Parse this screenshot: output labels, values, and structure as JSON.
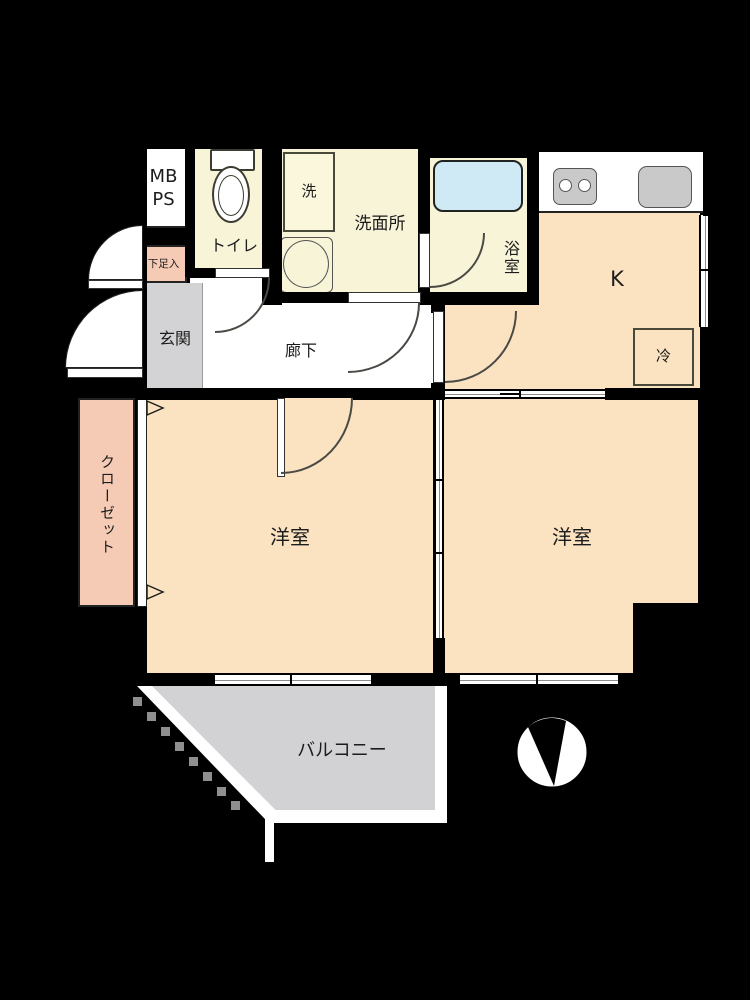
{
  "floorplan": {
    "labels": {
      "mb": "MB",
      "ps": "PS",
      "toilet": "トイレ",
      "washroom": "洗面所",
      "washer": "洗",
      "bathroom": "浴室",
      "kitchen": "K",
      "fridge": "冷",
      "shoe_cabinet": "下足入",
      "entrance": "玄関",
      "hallway": "廊下",
      "closet": "クローゼット",
      "room_left": "洋室",
      "room_right": "洋室",
      "balcony": "バルコニー"
    },
    "icons": {
      "compass": "north-arrow-compass",
      "doors": "quarter-circle-door-swings",
      "sliding_doors": "double-line-sliding-partitions"
    },
    "colors": {
      "background": "#000000",
      "wet_room_fill": "#f8f4d8",
      "room_fill": "#fbe3c2",
      "accent_pink": "#f6cbb6",
      "entrance_gray": "#d3d3d5",
      "balcony_gray": "#d2d2d4",
      "bathtub_blue": "#cfe9f5",
      "equipment_gray": "#c9c9c9",
      "wall": "#000000"
    }
  }
}
